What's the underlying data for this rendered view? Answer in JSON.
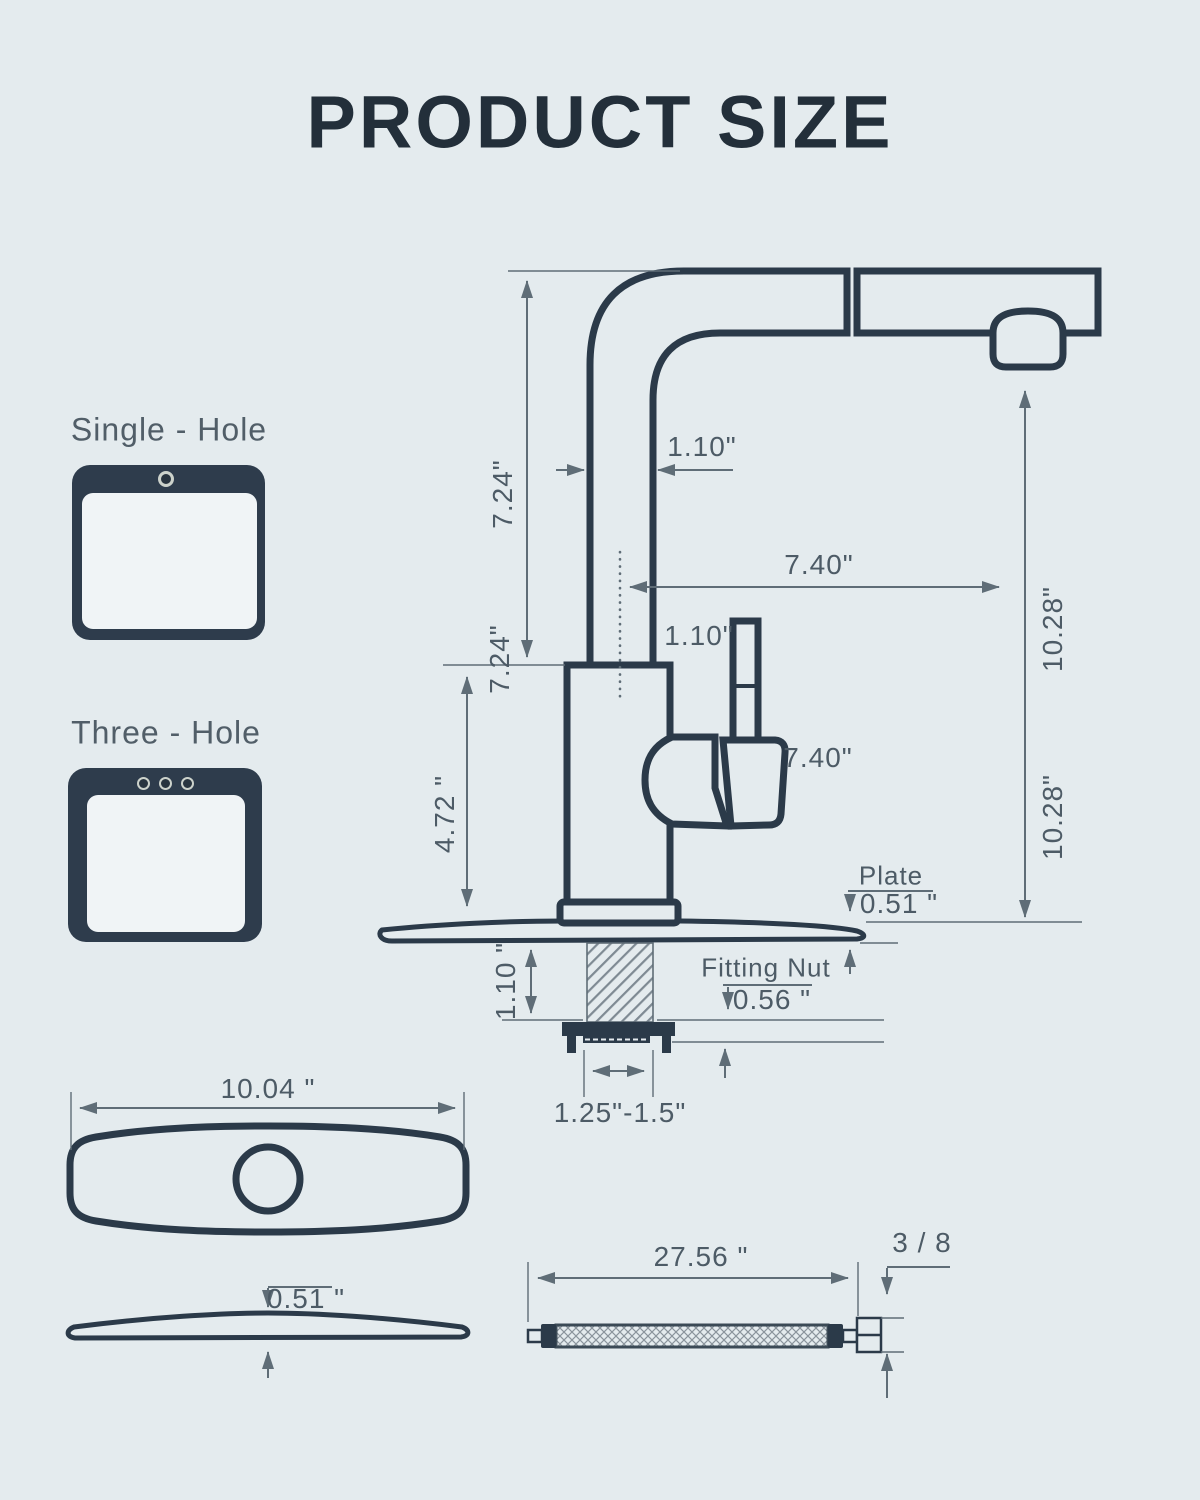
{
  "title": "PRODUCT SIZE",
  "sink_options": {
    "single_hole_label": "Single - Hole",
    "three_hole_label": "Three - Hole",
    "single_hole_icon": "sink-single-hole-icon",
    "three_hole_icon": "sink-three-hole-icon"
  },
  "faucet": {
    "spout_height_upper": "7.24\"",
    "spout_height_lower": "7.24\"",
    "spout_tube_width": "1.10\"",
    "spout_reach": "7.40\"",
    "outlet_height_upper": "10.28\"",
    "outlet_height_lower": "10.28\"",
    "handle_lever_width": "1.10\"",
    "handle_length": "7.40\"",
    "body_height": "4.72 \"",
    "plate_label": "Plate",
    "plate_thickness": "0.51 \"",
    "fitting_nut_label": "Fitting Nut",
    "fitting_nut_size": "0.56 \"",
    "shank_height": "1.10 \"",
    "mount_hole_diameter": "1.25\"-1.5\""
  },
  "deck_plate": {
    "width": "10.04 \"",
    "thickness": "0.51 \""
  },
  "supply_hose": {
    "length": "27.56 \"",
    "thread_size": "3 / 8"
  },
  "colors": {
    "background": "#e4ebee",
    "line_dark": "#2b3a49",
    "dimension_line": "#5f6d77",
    "dimension_text": "#4d5b66",
    "title_text": "#232f3a",
    "icon_fill": "#2e3c4c",
    "icon_inner": "#f0f4f6",
    "icon_hole_ring": "#ccd2cb"
  }
}
